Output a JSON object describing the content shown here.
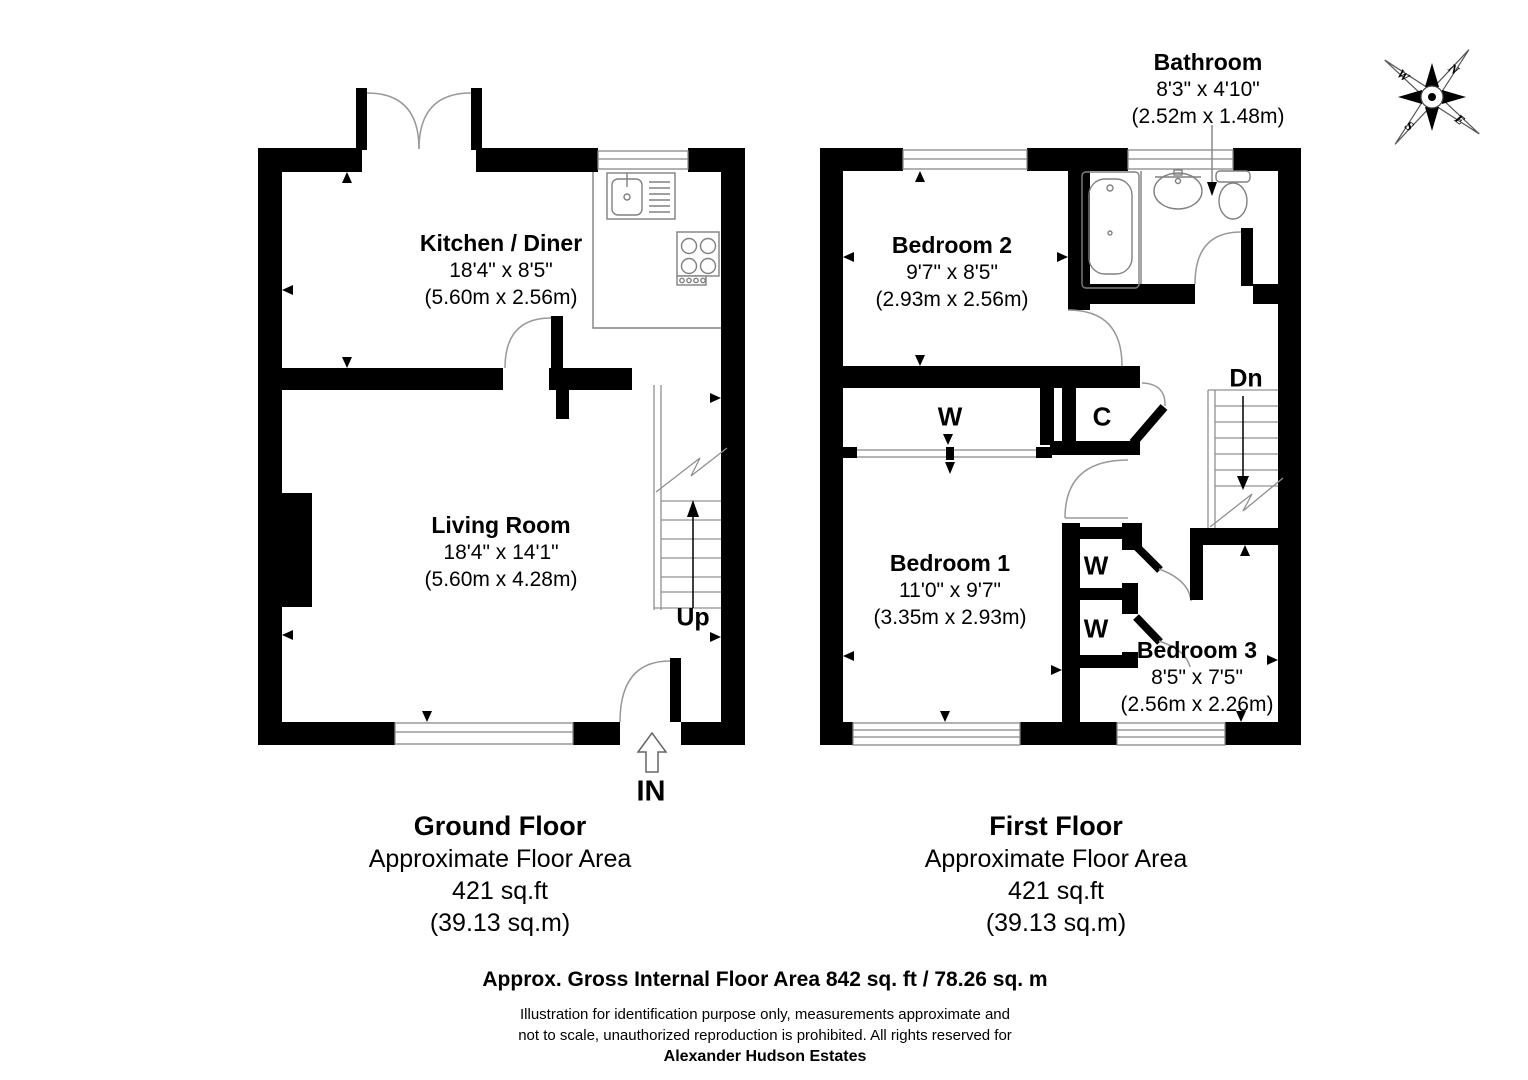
{
  "ground_floor": {
    "title": "Ground Floor",
    "area_caption": "Approximate Floor Area",
    "area_sqft": "421 sq.ft",
    "area_sqm": "(39.13 sq.m)",
    "rooms": {
      "kitchen": {
        "name": "Kitchen / Diner",
        "imperial": "18'4\" x 8'5\"",
        "metric": "(5.60m x 2.56m)"
      },
      "living": {
        "name": "Living Room",
        "imperial": "18'4\" x 14'1\"",
        "metric": "(5.60m x 4.28m)"
      }
    },
    "stairs_label": "Up",
    "entrance_label": "IN"
  },
  "first_floor": {
    "title": "First Floor",
    "area_caption": "Approximate Floor Area",
    "area_sqft": "421 sq.ft",
    "area_sqm": "(39.13 sq.m)",
    "rooms": {
      "bedroom2": {
        "name": "Bedroom 2",
        "imperial": "9'7\" x 8'5\"",
        "metric": "(2.93m x 2.56m)"
      },
      "bathroom": {
        "name": "Bathroom",
        "imperial": "8'3\" x 4'10\"",
        "metric": "(2.52m x 1.48m)"
      },
      "bedroom1": {
        "name": "Bedroom 1",
        "imperial": "11'0\" x 9'7\"",
        "metric": "(3.35m x 2.93m)"
      },
      "bedroom3": {
        "name": "Bedroom 3",
        "imperial": "8'5\" x 7'5\"",
        "metric": "(2.56m x 2.26m)"
      }
    },
    "stairs_label": "Dn",
    "closets": {
      "wardrobe_main": "W",
      "cupboard": "C",
      "wardrobe_1": "W",
      "wardrobe_2": "W"
    }
  },
  "compass": {
    "n": "N",
    "e": "E",
    "s": "S",
    "w": "W"
  },
  "footer": {
    "gross_area": "Approx. Gross Internal Floor Area 842 sq. ft / 78.26 sq. m",
    "disclaimer_line1": "Illustration for identification purpose only, measurements approximate and",
    "disclaimer_line2": "not to scale, unauthorized reproduction is prohibited. All rights reserved for",
    "agency": "Alexander Hudson Estates"
  }
}
